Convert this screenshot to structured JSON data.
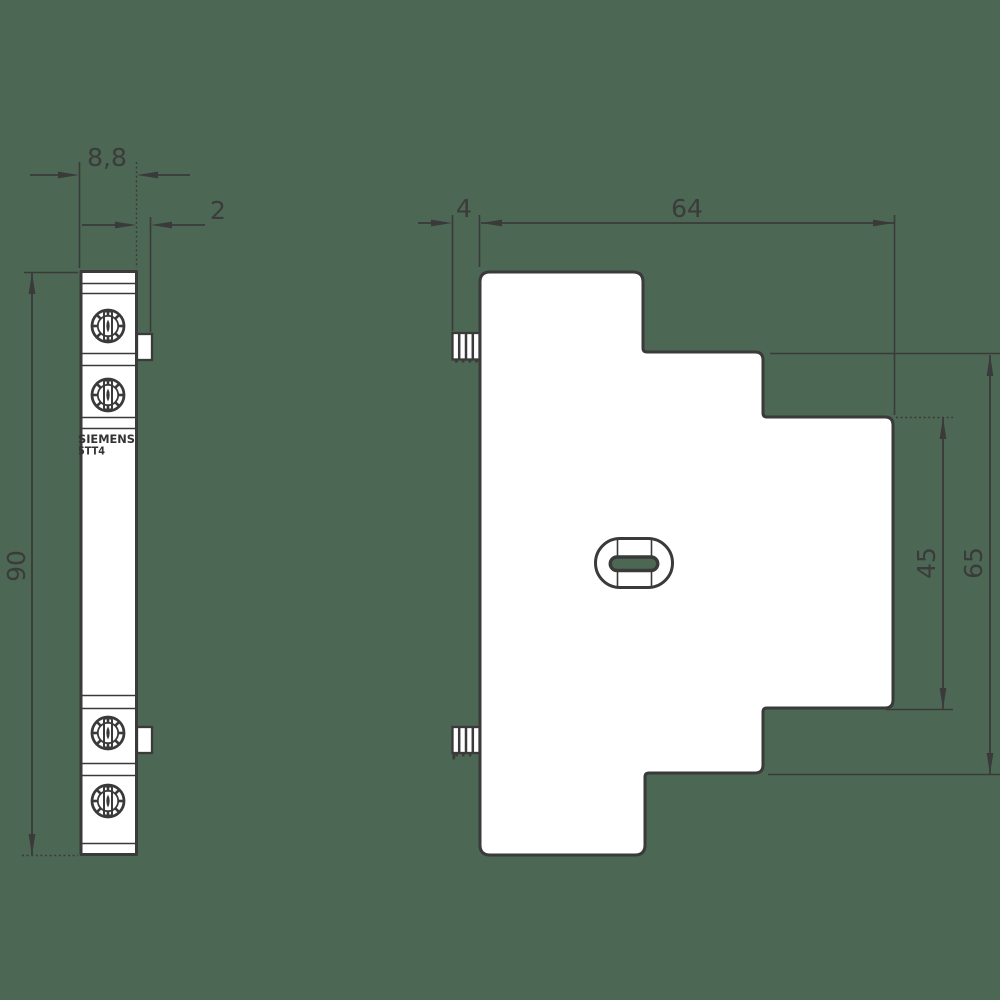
{
  "drawing": {
    "brand_label": "SIEMENS",
    "model_label": "5TT4",
    "units": "mm",
    "front_view": {
      "width_dim": "8,8",
      "tab_dim": "2",
      "height_dim": "90"
    },
    "side_view": {
      "rail_tab_dim": "4",
      "depth_dim": "64",
      "step_height_dim": "45",
      "height_dim": "65"
    },
    "colors": {
      "background": "#4c6753",
      "line": "#3a3a3a",
      "fill": "#ffffff"
    }
  }
}
